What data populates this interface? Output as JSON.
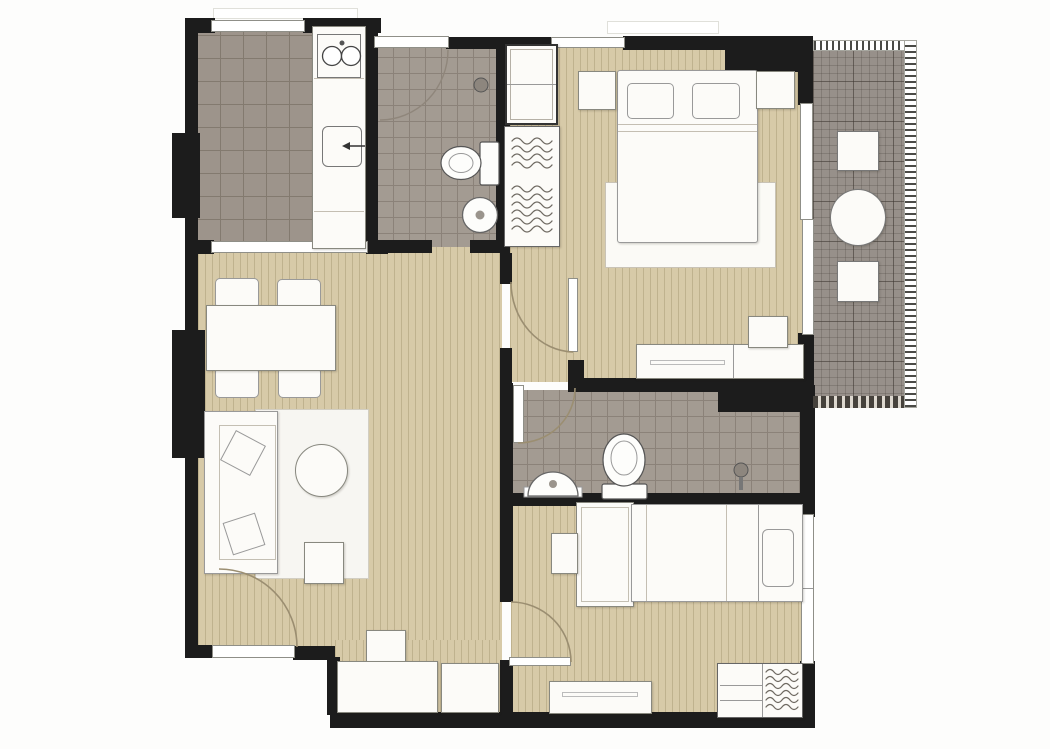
{
  "meta": {
    "title": "Two-bedroom condominium floor plan with balcony",
    "type": "architectural floor plan (top view), no text labels",
    "canvas": {
      "width": 1050,
      "height": 749
    }
  },
  "palette": {
    "background": "#fdfdfc",
    "wall": "#1c1c1c",
    "wood": "#d7caa8",
    "wood_line": "#bfb28e",
    "tile": "#a39b92",
    "tile_line": "#8b8279",
    "kitchen_tile": "#9d948b",
    "balcony": "#97908a",
    "furniture": "#fcfbf8",
    "outline": "#88887f",
    "arc": "#9b8e71"
  },
  "rooms": [
    {
      "id": "kitchen",
      "name": "Kitchen",
      "floor": "dark tile",
      "features": [
        "counter strip",
        "double sink",
        "cooktop with arrow mark",
        "window"
      ]
    },
    {
      "id": "bathroom-1",
      "name": "Bathroom 1",
      "floor": "tile",
      "features": [
        "curved shower screen",
        "shower head",
        "toilet",
        "round washbasin",
        "window"
      ]
    },
    {
      "id": "master-bedroom",
      "name": "Master Bedroom",
      "floor": "wood strip",
      "features": [
        "double bed",
        "two pillows",
        "two nightstands",
        "foot platform",
        "shelf cabinet",
        "open wardrobe with hangers",
        "dresser console",
        "tv stand",
        "sliding door to balcony",
        "window"
      ]
    },
    {
      "id": "balcony",
      "name": "Balcony",
      "floor": "outdoor grid tile",
      "features": [
        "two square stools",
        "round table",
        "dotted railing"
      ]
    },
    {
      "id": "living-dining",
      "name": "Living / Dining Room",
      "floor": "wood strip",
      "features": [
        "dining table",
        "four chairs",
        "sofa with two cushions",
        "rug",
        "round coffee table",
        "side table",
        "entry stool",
        "two storage cabinets",
        "main entrance door"
      ]
    },
    {
      "id": "bathroom-2",
      "name": "Bathroom 2",
      "floor": "tile",
      "features": [
        "semicircular washbasin",
        "toilet",
        "shower head",
        "shower partition"
      ]
    },
    {
      "id": "bedroom-2",
      "name": "Bedroom 2",
      "floor": "wood strip",
      "features": [
        "single bed",
        "pillow",
        "desk unit",
        "stool",
        "low console",
        "wardrobe with hangers",
        "window"
      ]
    }
  ],
  "doors": [
    {
      "name": "main-entrance-door",
      "swing": "into living room, bottom-left"
    },
    {
      "name": "kitchen-opening",
      "swing": "open threshold to dining"
    },
    {
      "name": "bathroom-1-door",
      "swing": "bottom wall opening"
    },
    {
      "name": "master-bedroom-door",
      "swing": "from hall into bedroom"
    },
    {
      "name": "bathroom-2-door",
      "swing": "from hall into bathroom"
    },
    {
      "name": "bedroom-2-door",
      "swing": "into bedroom 2"
    },
    {
      "name": "balcony-sliding-door",
      "swing": "two-panel slider"
    }
  ]
}
